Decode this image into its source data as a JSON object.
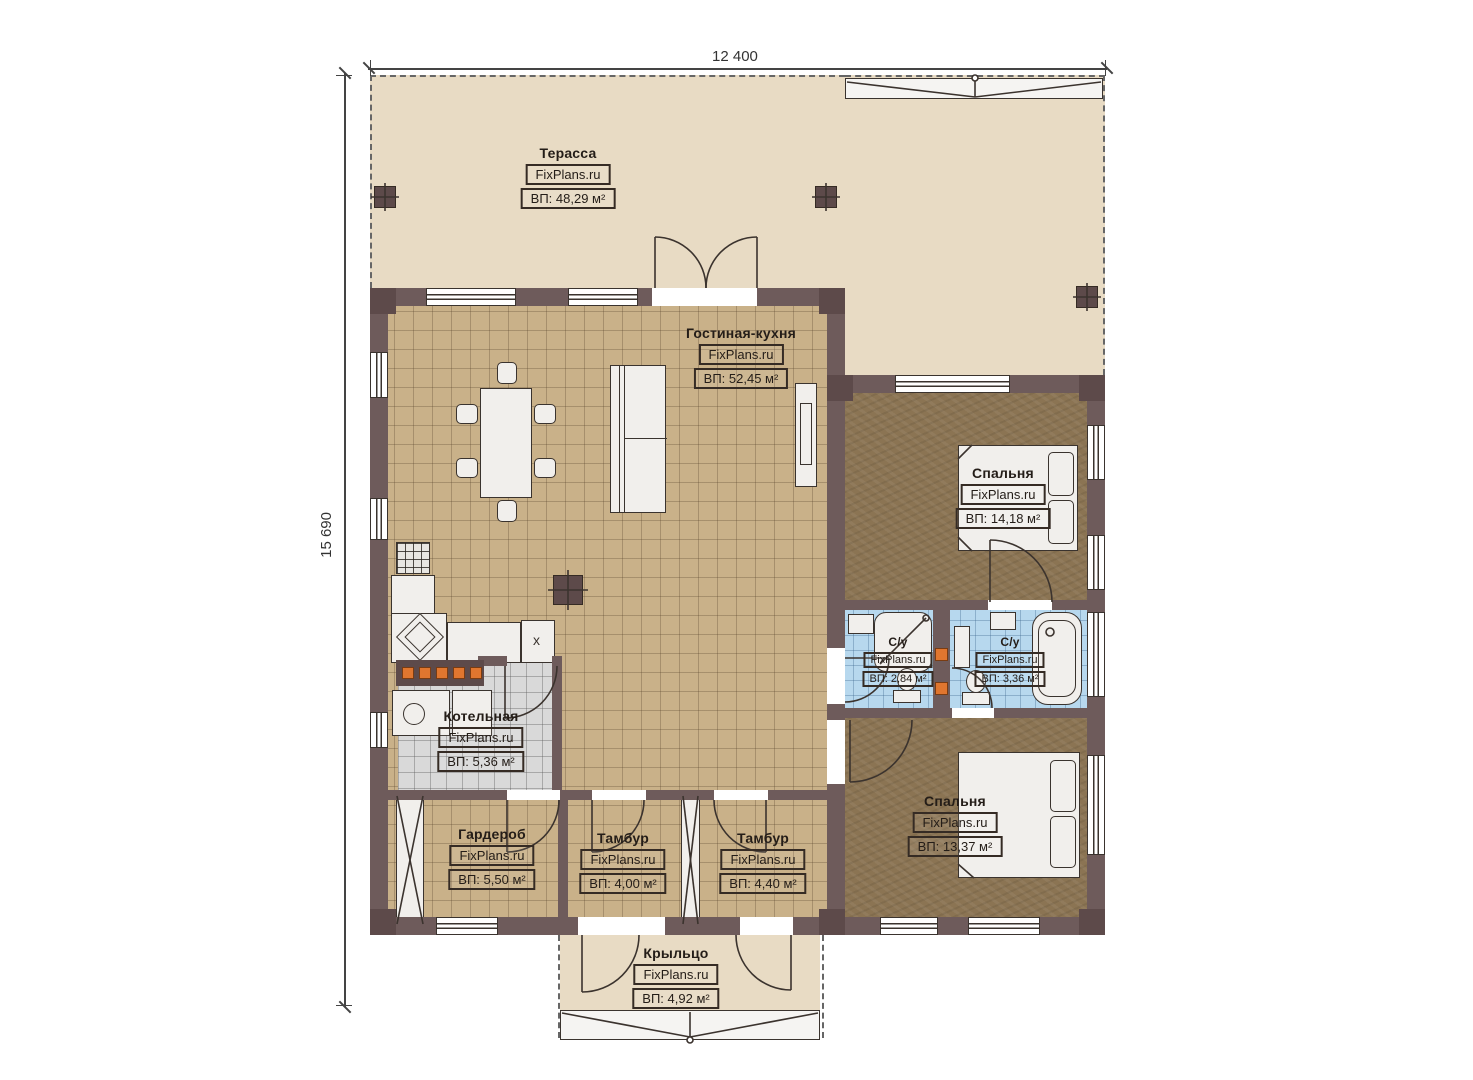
{
  "watermark": "FixPlans.ru",
  "dimensions": {
    "width_label": "12 400",
    "height_label": "15 690"
  },
  "kitchen": {
    "cabinet_marker": "x"
  },
  "colors": {
    "wall": "#6e5b5b",
    "wall_dark": "#5d4a4a",
    "floor_living": "#c9b189",
    "floor_bedroom": "#8b7453",
    "floor_bath": "#b7d8ee",
    "floor_boiler": "#d9d9d9",
    "terrace": "#e8dbc4",
    "orange_marker": "#e0762f"
  },
  "rooms": [
    {
      "name": "Терасса",
      "area": "ВП: 48,29 м²"
    },
    {
      "name": "Гостиная-кухня",
      "area": "ВП: 52,45 м²"
    },
    {
      "name": "Спальня",
      "area": "ВП: 14,18 м²"
    },
    {
      "name": "С/у",
      "area": "ВП: 2,84 м²"
    },
    {
      "name": "С/у",
      "area": "ВП: 3,36 м²"
    },
    {
      "name": "Котельная",
      "area": "ВП: 5,36 м²"
    },
    {
      "name": "Гардероб",
      "area": "ВП: 5,50 м²"
    },
    {
      "name": "Тамбур",
      "area": "ВП: 4,00 м²"
    },
    {
      "name": "Тамбур",
      "area": "ВП: 4,40 м²"
    },
    {
      "name": "Спальня",
      "area": "ВП: 13,37 м²"
    },
    {
      "name": "Крыльцо",
      "area": "ВП: 4,92 м²"
    }
  ]
}
